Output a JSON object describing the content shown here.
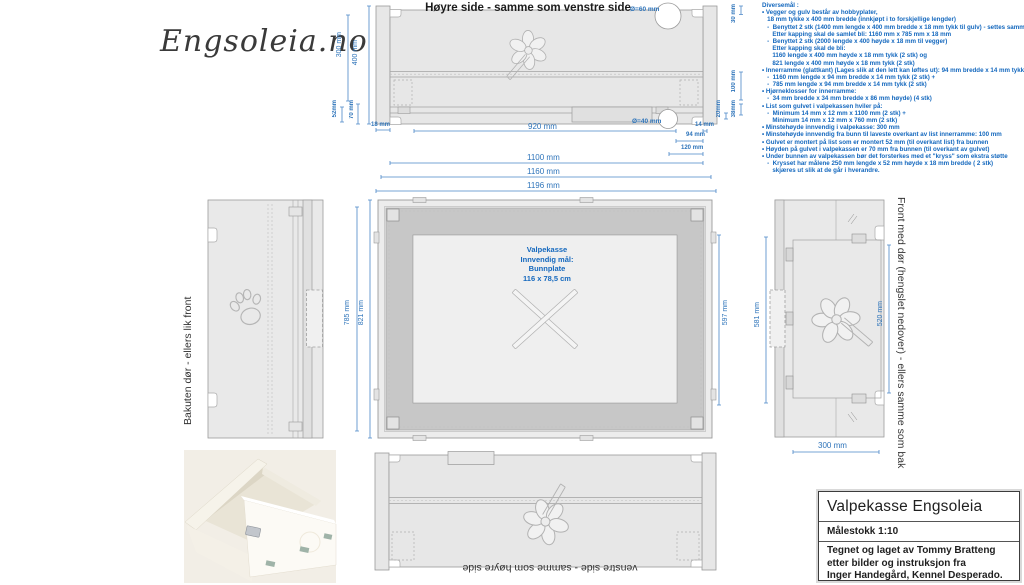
{
  "logo": "Engsoleia.no",
  "colors": {
    "dim_blue": "#2e74ba",
    "note_blue": "#1468be"
  },
  "top_view": {
    "title": "Høyre side - samme som venstre side",
    "hole_top": "Ø=60 mm",
    "hole_bottom": "Ø=40 mm",
    "dims": {
      "d300": "300 mm",
      "d400": "400 mm",
      "d52": "52mm",
      "d70": "70 mm",
      "d18": "18 mm",
      "d920": "920 mm",
      "d30": "30 mm",
      "d100": "100 mm",
      "d38": "38mm",
      "d20": "20mm",
      "d14": "14 mm",
      "d94": "94 mm",
      "d120": "120 mm",
      "d1100": "1100 mm",
      "d1160": "1160 mm",
      "d1196": "1196 mm"
    }
  },
  "back_view": {
    "label": "Bakuten dør - ellers lik front"
  },
  "plan_view": {
    "label_lines": [
      "Valpekasse",
      "Innvendig mål:",
      "Bunnplate",
      "116 x 78,5 cm"
    ],
    "dims": {
      "d785": "785 mm",
      "d821": "821 mm",
      "d597": "597 mm"
    }
  },
  "front_view": {
    "label": "Front med dør (hengslet nedover) - ellers samme som bak",
    "dims": {
      "d581": "581 mm",
      "d520": "520 mm",
      "d300": "300 mm"
    }
  },
  "bottom_view": {
    "label": "venstre side - samme som høyre side"
  },
  "notes": {
    "title": "Diversemål :",
    "lines": [
      "• Vegger og gulv består av hobbyplater,",
      "   18 mm tykke x 400 mm bredde (innkjøpt i to forskjellige lengder)",
      "   -  Benyttet 2 stk (1400 mm lengde x 400 mm bredde x 18 mm tykk til gulv) - settes sammen)",
      "      Etter kapping skal de samlet bli: 1160 mm x 785 mm x 18 mm",
      "   -  Benyttet 2 stk (2000 lengde x 400 høyde x 18 mm til vegger)",
      "      Etter kapping skal de bli:",
      "      1160 lengde x 400 mm høyde x 18 mm tykk (2 stk) og",
      "      821 lengde x 400 mm høyde x 18 mm tykk (2 stk)",
      "• Innerramme (glattkant) (Lages slik at den lett kan løftes ut): 94 mm bredde x 14 mm tykk)",
      "   -  1160 mm lengde x 94 mm bredde x 14 mm tykk (2 stk) +",
      "   -  785 mm lengde x 94 mm bredde x 14 mm tykk (2 stk)",
      "• Hjørneklosser for innerramme:",
      "   -  34 mm bredde x 34 mm bredde x 86 mm høyde) (4 stk)",
      "• List som gulvet i valpekassen hviler på:",
      "   -  Minimum 14 mm x 12 mm x 1100 mm (2 stk) +",
      "      Minimum 14 mm x 12 mm x 760 mm (2 stk)",
      "• Minstehøyde innvendig i valpekasse: 300 mm",
      "• Minstehøyde innvendig fra bunn til laveste overkant av list innerramme: 100 mm",
      "• Gulvet er montert på list som er montert 52 mm (til overkant list) fra bunnen",
      "• Høyden på gulvet i valpekassen er 70 mm fra bunnen (til overkant av gulvet)",
      "• Under bunnen av valpekassen bør det forsterkes med et \"kryss\" som ekstra støtte",
      "   -  Krysset har målene 250 mm lengde x 52 mm høyde x 18 mm bredde ( 2 stk)",
      "      skjæres ut slik at de går i hverandre."
    ]
  },
  "title_block": {
    "title": "Valpekasse Engsoleia",
    "scale": "Målestokk 1:10",
    "credit_lines": [
      "Tegnet og laget av Tommy Bratteng",
      "etter bilder og instruksjon fra",
      "Inger Handegård, Kennel Desperado."
    ]
  }
}
